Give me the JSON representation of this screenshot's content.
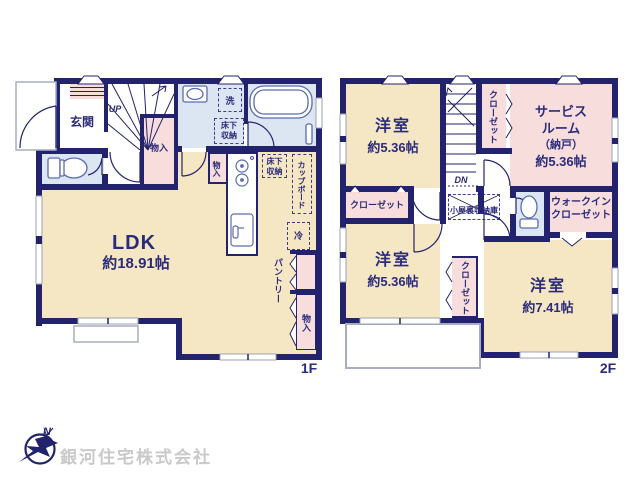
{
  "floor1": {
    "label": "1F",
    "genkan": "玄関",
    "up": "UP",
    "monoire": "物入",
    "laundry": "洗",
    "underfloor_l1": "床下",
    "underfloor_l2": "収納",
    "cupboard": "カップボード",
    "fridge": "冷",
    "ldk": "LDK",
    "ldk_size": "約18.91帖",
    "pantry": "パントリー"
  },
  "floor2": {
    "label": "2F",
    "dn": "DN",
    "yoshitsu": "洋室",
    "size_536": "約5.36帖",
    "size_741": "約7.41帖",
    "closet": "クローゼット",
    "service_l1": "サービス",
    "service_l2": "ルーム",
    "service_l3": "（納戸）",
    "attic": "小屋裏収納庫",
    "wic_l1": "ウォークイン",
    "wic_l2": "クローゼット",
    "balcony": "バルコニー"
  },
  "footer": {
    "company": "銀河住宅株式会社",
    "compass_n": "N"
  },
  "colors": {
    "wall": "#23226d",
    "cream": "#f5e7c3",
    "pink": "#f8dddd",
    "blue": "#dce6f2"
  }
}
